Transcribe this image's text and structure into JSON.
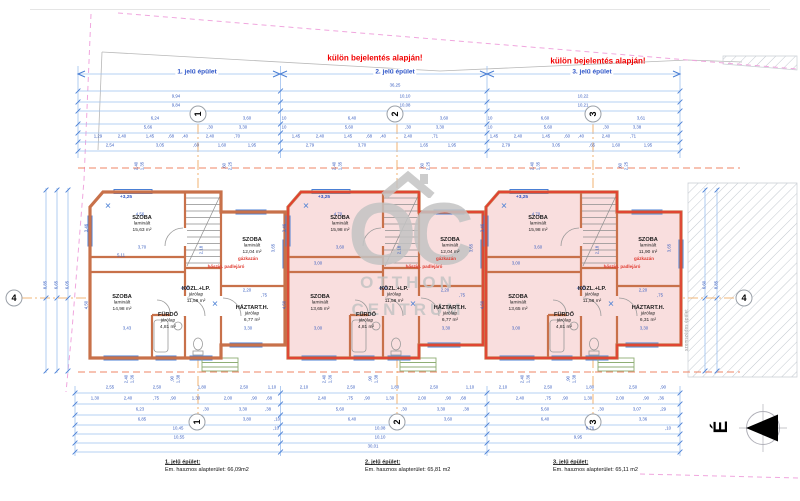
{
  "colors": {
    "accent_blue": "#2f56c8",
    "dim_blue": "#3a5fc0",
    "line_blue": "#9ec0ef",
    "tick_blue": "#4a7fd4",
    "wall_orange": "#c8714a",
    "unit_pink": "#f9dede",
    "unit_red": "#e8392b",
    "permit_red": "#f20000",
    "note_red": "#e03a2f",
    "boundary_pink": "#f0a6de",
    "axis_orange": "#eda04f",
    "section_orange": "#ef8566",
    "watermark_gray": "#c4c4c4"
  },
  "header": {
    "permit_note": "külön bejelentés alapján!",
    "buildings": [
      {
        "label": "1. jelű épület",
        "x": 197
      },
      {
        "label": "2. jelű épület",
        "x": 395
      },
      {
        "label": "3. jelű épület",
        "x": 592
      }
    ]
  },
  "axes": [
    {
      "x": 198,
      "y": 114,
      "label": "1",
      "rot": true
    },
    {
      "x": 395,
      "y": 114,
      "label": "2",
      "rot": true
    },
    {
      "x": 593,
      "y": 114,
      "label": "3",
      "rot": true
    },
    {
      "x": 14,
      "y": 298,
      "label": "4",
      "rot": false
    },
    {
      "x": 744,
      "y": 298,
      "label": "4",
      "rot": false
    },
    {
      "x": 197,
      "y": 422,
      "label": "1",
      "rot": true
    },
    {
      "x": 397,
      "y": 422,
      "label": "2",
      "rot": true
    },
    {
      "x": 593,
      "y": 422,
      "label": "3",
      "rot": true
    }
  ],
  "units": [
    {
      "L": 90,
      "red": false,
      "level": "+3,25",
      "rooms": [
        {
          "dx": 52,
          "y": 214,
          "name": "SZOBA",
          "finish": "laminált",
          "area": "15,63 m²"
        },
        {
          "dx": 162,
          "y": 236,
          "name": "SZOBA",
          "finish": "laminált",
          "area": "12,04 m²"
        },
        {
          "dx": 32,
          "y": 293,
          "name": "SZOBA",
          "finish": "laminált",
          "area": "14,98 m²"
        },
        {
          "dx": 106,
          "y": 285,
          "name": "KÖZL.+LP.",
          "finish": "járólap",
          "area": "11,58 m²"
        },
        {
          "dx": 78,
          "y": 311,
          "name": "FÜRDŐ",
          "finish": "járólap",
          "area": "4,81 m²"
        },
        {
          "dx": 162,
          "y": 304,
          "name": "HÁZTART.H.",
          "finish": "járólap",
          "area": "6,77 m²"
        }
      ],
      "notes": [
        {
          "dx": 158,
          "y": 259,
          "t": "gázkazán"
        },
        {
          "dx": 136,
          "y": 267,
          "t": "hőszig. padlejáró"
        }
      ]
    },
    {
      "L": 288,
      "red": true,
      "level": "+3,25",
      "rooms": [
        {
          "dx": 52,
          "y": 214,
          "name": "SZOBA",
          "finish": "laminált",
          "area": "15,98 m²"
        },
        {
          "dx": 162,
          "y": 236,
          "name": "SZOBA",
          "finish": "laminált",
          "area": "12,04 m²"
        },
        {
          "dx": 32,
          "y": 293,
          "name": "SZOBA",
          "finish": "laminált",
          "area": "13,65 m²"
        },
        {
          "dx": 106,
          "y": 285,
          "name": "KÖZL.+LP.",
          "finish": "járólap",
          "area": "11,58 m²"
        },
        {
          "dx": 78,
          "y": 311,
          "name": "FÜRDŐ",
          "finish": "járólap",
          "area": "4,81 m²"
        },
        {
          "dx": 162,
          "y": 304,
          "name": "HÁZTART.H.",
          "finish": "járólap",
          "area": "6,77 m²"
        }
      ],
      "notes": [
        {
          "dx": 158,
          "y": 259,
          "t": "gázkazán"
        },
        {
          "dx": 136,
          "y": 267,
          "t": "hőszig. padlejáró"
        }
      ]
    },
    {
      "L": 486,
      "red": true,
      "level": "+3,25",
      "rooms": [
        {
          "dx": 52,
          "y": 214,
          "name": "SZOBA",
          "finish": "laminált",
          "area": "15,98 m²"
        },
        {
          "dx": 162,
          "y": 236,
          "name": "SZOBA",
          "finish": "laminált",
          "area": "11,90 m²"
        },
        {
          "dx": 32,
          "y": 293,
          "name": "SZOBA",
          "finish": "laminált",
          "area": "13,65 m²"
        },
        {
          "dx": 106,
          "y": 285,
          "name": "KÖZL.+LP.",
          "finish": "járólap",
          "area": "11,58 m²"
        },
        {
          "dx": 78,
          "y": 311,
          "name": "FÜRDŐ",
          "finish": "járólap",
          "area": "4,81 m²"
        },
        {
          "dx": 162,
          "y": 304,
          "name": "HÁZTART.H.",
          "finish": "járólap",
          "area": "6,31 m²"
        }
      ],
      "notes": [
        {
          "dx": 158,
          "y": 259,
          "t": "gázkazán"
        },
        {
          "dx": 136,
          "y": 267,
          "t": "hőszig. padlejáró"
        }
      ]
    }
  ],
  "footer": [
    {
      "x": 165,
      "title": "1. jelű épület:",
      "line": "Em. hasznos alapterület: 66,09m2"
    },
    {
      "x": 365,
      "title": "2. jelű épület:",
      "line": "Em. hasznos alapterület: 65,81 m2"
    },
    {
      "x": 553,
      "title": "3. jelű épület:",
      "line": "Em. hasznos alapterület: 65,11 m2"
    }
  ],
  "north": {
    "label": "É"
  },
  "watermark": {
    "letters": "OC",
    "line1": "OTTHON",
    "line2": "CENTRUM"
  },
  "side_note": {
    "x": 687,
    "y": 330,
    "text": "szomszédos épület"
  },
  "dim_labels": [
    [
      395,
      86,
      "36,25"
    ],
    [
      176,
      97,
      "9,94"
    ],
    [
      405,
      97,
      "10,10"
    ],
    [
      583,
      97,
      "10,22"
    ],
    [
      176,
      106,
      "9,84"
    ],
    [
      405,
      106,
      "10,08"
    ],
    [
      583,
      106,
      "10,21"
    ],
    [
      155,
      119,
      "6,24"
    ],
    [
      247,
      119,
      "3,60"
    ],
    [
      284,
      119,
      "10"
    ],
    [
      352,
      119,
      "6,40"
    ],
    [
      444,
      119,
      "3,60"
    ],
    [
      490,
      119,
      "10"
    ],
    [
      545,
      119,
      "6,60"
    ],
    [
      641,
      119,
      "3,61"
    ],
    [
      148,
      128,
      "5,66"
    ],
    [
      210,
      128,
      ",30"
    ],
    [
      243,
      128,
      "3,30"
    ],
    [
      284,
      128,
      "10"
    ],
    [
      349,
      128,
      "5,60"
    ],
    [
      408,
      128,
      ",30"
    ],
    [
      440,
      128,
      "3,30"
    ],
    [
      490,
      128,
      "10"
    ],
    [
      548,
      128,
      "5,60"
    ],
    [
      606,
      128,
      ",30"
    ],
    [
      637,
      128,
      "3,38"
    ],
    [
      98,
      137,
      "1,29"
    ],
    [
      122,
      137,
      "2,40"
    ],
    [
      150,
      137,
      "1,45"
    ],
    [
      171,
      137,
      ",68"
    ],
    [
      185,
      137,
      ",40"
    ],
    [
      210,
      137,
      "2,40"
    ],
    [
      237,
      137,
      ",70"
    ],
    [
      296,
      137,
      "1,45"
    ],
    [
      320,
      137,
      "2,40"
    ],
    [
      348,
      137,
      "1,45"
    ],
    [
      369,
      137,
      ",68"
    ],
    [
      383,
      137,
      ",40"
    ],
    [
      408,
      137,
      "2,40"
    ],
    [
      435,
      137,
      ",71"
    ],
    [
      494,
      137,
      "1,45"
    ],
    [
      518,
      137,
      "2,40"
    ],
    [
      546,
      137,
      "1,45"
    ],
    [
      567,
      137,
      ",60"
    ],
    [
      581,
      137,
      ",40"
    ],
    [
      606,
      137,
      "2,40"
    ],
    [
      633,
      137,
      ",71"
    ],
    [
      110,
      146,
      "2,54"
    ],
    [
      160,
      146,
      "3,05"
    ],
    [
      196,
      146,
      ",60"
    ],
    [
      222,
      146,
      "1,60"
    ],
    [
      252,
      146,
      "1,95"
    ],
    [
      310,
      146,
      "2,79"
    ],
    [
      362,
      146,
      "3,70"
    ],
    [
      424,
      146,
      "1,65"
    ],
    [
      452,
      146,
      "1,95"
    ],
    [
      506,
      146,
      "2,79"
    ],
    [
      556,
      146,
      "3,05"
    ],
    [
      592,
      146,
      ",65"
    ],
    [
      616,
      146,
      "1,60"
    ],
    [
      648,
      146,
      "1,95"
    ],
    [
      140,
      215,
      "4,56"
    ],
    [
      142,
      248,
      "3,70"
    ],
    [
      121,
      256,
      "5,11"
    ],
    [
      185,
      289,
      "4,00"
    ],
    [
      127,
      329,
      "3,43"
    ],
    [
      248,
      329,
      "3,30"
    ],
    [
      247,
      291,
      "2,20"
    ],
    [
      264,
      296,
      ",75"
    ],
    [
      338,
      215,
      "4,70"
    ],
    [
      340,
      248,
      "3,60"
    ],
    [
      318,
      264,
      "3,00"
    ],
    [
      383,
      289,
      "4,00"
    ],
    [
      318,
      329,
      "3,00"
    ],
    [
      446,
      329,
      "3,30"
    ],
    [
      445,
      291,
      "2,20"
    ],
    [
      462,
      296,
      ",75"
    ],
    [
      536,
      215,
      "4,70"
    ],
    [
      538,
      248,
      "3,60"
    ],
    [
      516,
      264,
      "3,00"
    ],
    [
      581,
      289,
      "4,00"
    ],
    [
      516,
      329,
      "3,00"
    ],
    [
      644,
      329,
      "3,30"
    ],
    [
      643,
      291,
      "2,20"
    ],
    [
      660,
      296,
      ",75"
    ],
    [
      110,
      388,
      "2,55"
    ],
    [
      157,
      388,
      "2,50"
    ],
    [
      202,
      388,
      "1,80"
    ],
    [
      244,
      388,
      "2,50"
    ],
    [
      272,
      388,
      "1,10"
    ],
    [
      304,
      388,
      "2,10"
    ],
    [
      351,
      388,
      "2,50"
    ],
    [
      395,
      388,
      "1,80"
    ],
    [
      434,
      388,
      "2,50"
    ],
    [
      470,
      388,
      "1,10"
    ],
    [
      503,
      388,
      "2,10"
    ],
    [
      548,
      388,
      "2,50"
    ],
    [
      590,
      388,
      "1,80"
    ],
    [
      633,
      388,
      "2,50"
    ],
    [
      663,
      388,
      ",90"
    ],
    [
      95,
      399,
      "1,30"
    ],
    [
      128,
      399,
      "2,40"
    ],
    [
      156,
      399,
      ",75"
    ],
    [
      173,
      399,
      ",90"
    ],
    [
      196,
      399,
      "1,30"
    ],
    [
      228,
      399,
      "2,00"
    ],
    [
      254,
      399,
      ",90"
    ],
    [
      269,
      399,
      ",68"
    ],
    [
      322,
      399,
      "2,40"
    ],
    [
      350,
      399,
      ",75"
    ],
    [
      367,
      399,
      ",90"
    ],
    [
      390,
      399,
      "1,30"
    ],
    [
      422,
      399,
      "2,00"
    ],
    [
      448,
      399,
      ",90"
    ],
    [
      463,
      399,
      ",68"
    ],
    [
      520,
      399,
      "2,40"
    ],
    [
      548,
      399,
      ",75"
    ],
    [
      565,
      399,
      ",90"
    ],
    [
      588,
      399,
      "1,30"
    ],
    [
      620,
      399,
      "2,00"
    ],
    [
      646,
      399,
      ",90"
    ],
    [
      661,
      399,
      ",36"
    ],
    [
      140,
      410,
      "6,23"
    ],
    [
      206,
      410,
      ",30"
    ],
    [
      243,
      410,
      "3,30"
    ],
    [
      268,
      410,
      ",38"
    ],
    [
      340,
      410,
      "5,60"
    ],
    [
      404,
      410,
      ",30"
    ],
    [
      441,
      410,
      "3,30"
    ],
    [
      466,
      410,
      ",38"
    ],
    [
      545,
      410,
      "5,60"
    ],
    [
      601,
      410,
      ",30"
    ],
    [
      637,
      410,
      "3,07"
    ],
    [
      663,
      410,
      ",29"
    ],
    [
      142,
      420,
      "6,85"
    ],
    [
      247,
      420,
      "3,80"
    ],
    [
      277,
      420,
      ",10"
    ],
    [
      352,
      420,
      "6,40"
    ],
    [
      448,
      420,
      "3,60"
    ],
    [
      545,
      420,
      "6,40"
    ],
    [
      643,
      420,
      "3,36"
    ],
    [
      178,
      429,
      "10,45"
    ],
    [
      276,
      429,
      ",10"
    ],
    [
      380,
      429,
      "10,08"
    ],
    [
      590,
      429,
      "9,76"
    ],
    [
      668,
      429,
      ",10"
    ],
    [
      179,
      438,
      "10,55"
    ],
    [
      380,
      438,
      "10,10"
    ],
    [
      578,
      438,
      "9,95"
    ],
    [
      373,
      447,
      "30,01"
    ]
  ],
  "dim_labels_rot": [
    [
      46,
      285,
      "8,85"
    ],
    [
      57,
      285,
      "6,65"
    ],
    [
      68,
      285,
      "6,05"
    ],
    [
      87,
      228,
      "3,46"
    ],
    [
      87,
      305,
      "4,50"
    ],
    [
      285,
      228,
      "3,46"
    ],
    [
      285,
      305,
      "4,50"
    ],
    [
      483,
      228,
      "3,46"
    ],
    [
      483,
      305,
      "4,50"
    ],
    [
      274,
      248,
      "3,65"
    ],
    [
      472,
      248,
      "3,65"
    ],
    [
      670,
      248,
      "3,65"
    ],
    [
      202,
      250,
      "2,18"
    ],
    [
      400,
      250,
      "2,18"
    ],
    [
      598,
      250,
      "2,18"
    ],
    [
      137,
      166,
      "2,40"
    ],
    [
      143,
      166,
      "1,35"
    ],
    [
      225,
      166,
      ",60"
    ],
    [
      231,
      166,
      "2,25"
    ],
    [
      335,
      166,
      "2,40"
    ],
    [
      341,
      166,
      "1,35"
    ],
    [
      423,
      166,
      ",60"
    ],
    [
      429,
      166,
      "2,25"
    ],
    [
      533,
      166,
      "2,40"
    ],
    [
      539,
      166,
      "1,35"
    ],
    [
      621,
      166,
      ",60"
    ],
    [
      627,
      166,
      "2,25"
    ],
    [
      127,
      379,
      "2,40"
    ],
    [
      133,
      379,
      "1,36"
    ],
    [
      173,
      379,
      ",90"
    ],
    [
      179,
      379,
      "1,38"
    ],
    [
      325,
      379,
      "2,40"
    ],
    [
      331,
      379,
      "1,36"
    ],
    [
      371,
      379,
      ",90"
    ],
    [
      377,
      379,
      "1,38"
    ],
    [
      523,
      379,
      "2,40"
    ],
    [
      529,
      379,
      "1,36"
    ],
    [
      569,
      379,
      ",90"
    ],
    [
      575,
      379,
      "1,38"
    ],
    [
      705,
      285,
      "6,60"
    ],
    [
      717,
      285,
      "8,85"
    ]
  ],
  "dim_lines": {
    "top": {
      "x1": 78,
      "x2": 680,
      "rows": [
        91,
        102,
        111,
        124,
        133,
        142,
        151
      ]
    },
    "bottom": {
      "x1": 75,
      "x2": 680,
      "rows": [
        393,
        404,
        415,
        425,
        434,
        443,
        452
      ]
    },
    "vtop": {
      "y1": 66,
      "y2": 158,
      "xs": [
        78,
        280.5,
        487,
        680
      ]
    },
    "vbottom": {
      "y1": 386,
      "y2": 456,
      "xs": [
        75,
        280.5,
        487,
        680
      ]
    },
    "vleft": {
      "y1": 188,
      "y2": 373,
      "xs": [
        46,
        57,
        68
      ]
    },
    "vright": {
      "y1": 188,
      "y2": 373,
      "xs": [
        705,
        717
      ]
    },
    "band": {
      "y": 74,
      "segs": [
        [
          78,
          280
        ],
        [
          280,
          487
        ],
        [
          487,
          680
        ]
      ]
    }
  }
}
